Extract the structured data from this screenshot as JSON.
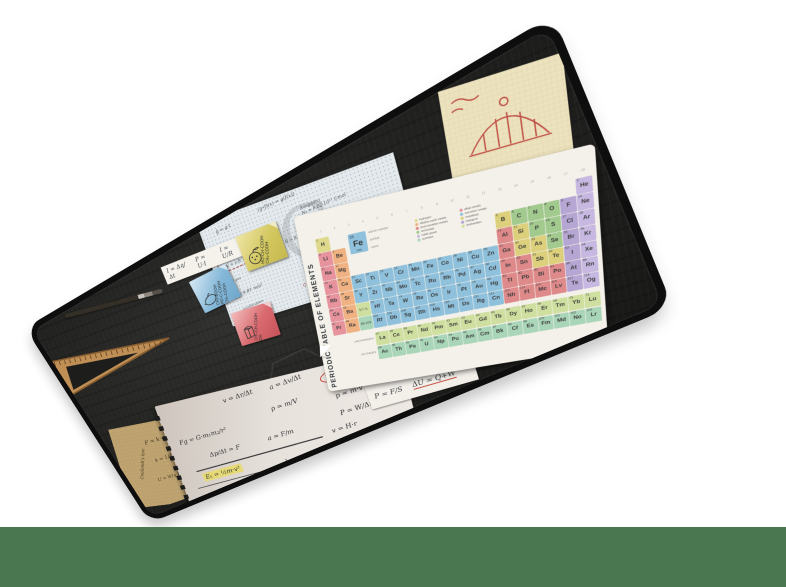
{
  "scene": {
    "background": "#ffffff",
    "bottom_bar_color": "#4a7750",
    "mat": {
      "surface_color": "#232322",
      "edge_color": "#0e0e0e",
      "brand": "natec"
    }
  },
  "periodic_table": {
    "title": "PERIODIC TABLE OF ELEMENTS",
    "group_numbers": [
      "1",
      "2",
      "3",
      "4",
      "5",
      "6",
      "7",
      "8",
      "9",
      "10",
      "11",
      "12",
      "13",
      "14",
      "15",
      "16",
      "17",
      "18"
    ],
    "sample": {
      "number": "26",
      "symbol": "Fe",
      "name": "Iron",
      "labels": [
        "atomic number",
        "symbol",
        "name"
      ]
    },
    "series_labels": {
      "lanthanides": "LANTHANIDES",
      "actinides": "ACTINIDES"
    },
    "legend": [
      {
        "label": "hydrogen",
        "key": "hy"
      },
      {
        "label": "alkali metals",
        "key": "alk"
      },
      {
        "label": "alkaline earth metals",
        "key": "ae"
      },
      {
        "label": "transition metals",
        "key": "tm"
      },
      {
        "label": "post-transition metals",
        "key": "ptm"
      },
      {
        "label": "metalloids",
        "key": "met"
      },
      {
        "label": "nonmetals",
        "key": "nm"
      },
      {
        "label": "halogens",
        "key": "hal"
      },
      {
        "label": "noble gases",
        "key": "ng"
      },
      {
        "label": "lanthanides",
        "key": "lan"
      },
      {
        "label": "actinides",
        "key": "act"
      }
    ],
    "colors": {
      "hy": "#ded98c",
      "alk": "#e6939e",
      "ae": "#f0b282",
      "tm": "#8fc1dc",
      "ptm": "#df8a8a",
      "met": "#dcd07c",
      "nm": "#a2ca8e",
      "hal": "#b5a6d4",
      "ng": "#c6b8e0",
      "lan": "#cfdf9f",
      "act": "#a9d5b8"
    },
    "grid": [
      [
        "1|H|hy",
        0,
        0,
        0,
        0,
        0,
        0,
        0,
        0,
        0,
        0,
        0,
        0,
        0,
        0,
        0,
        0,
        "2|He|ng"
      ],
      [
        "3|Li|alk",
        "4|Be|ae",
        0,
        0,
        0,
        0,
        0,
        0,
        0,
        0,
        0,
        0,
        "5|B|met",
        "6|C|nm",
        "7|N|nm",
        "8|O|nm",
        "9|F|hal",
        "10|Ne|ng"
      ],
      [
        "11|Na|alk",
        "12|Mg|ae",
        0,
        0,
        0,
        0,
        0,
        0,
        0,
        0,
        0,
        0,
        "13|Al|ptm",
        "14|Si|met",
        "15|P|nm",
        "16|S|nm",
        "17|Cl|hal",
        "18|Ar|ng"
      ],
      [
        "19|K|alk",
        "20|Ca|ae",
        "21|Sc|tm",
        "22|Ti|tm",
        "23|V|tm",
        "24|Cr|tm",
        "25|Mn|tm",
        "26|Fe|tm",
        "27|Co|tm",
        "28|Ni|tm",
        "29|Cu|tm",
        "30|Zn|tm",
        "31|Ga|ptm",
        "32|Ge|met",
        "33|As|met",
        "34|Se|nm",
        "35|Br|hal",
        "36|Kr|ng"
      ],
      [
        "37|Rb|alk",
        "38|Sr|ae",
        "39|Y|tm",
        "40|Zr|tm",
        "41|Nb|tm",
        "42|Mo|tm",
        "43|Tc|tm",
        "44|Ru|tm",
        "45|Rh|tm",
        "46|Pd|tm",
        "47|Ag|tm",
        "48|Cd|tm",
        "49|In|ptm",
        "50|Sn|ptm",
        "51|Sb|met",
        "52|Te|met",
        "53|I|hal",
        "54|Xe|ng"
      ],
      [
        "55|Cs|alk",
        "56|Ba|ae",
        "57-71||lan",
        "72|Hf|tm",
        "73|Ta|tm",
        "74|W|tm",
        "75|Re|tm",
        "76|Os|tm",
        "77|Ir|tm",
        "78|Pt|tm",
        "79|Au|tm",
        "80|Hg|tm",
        "81|Tl|ptm",
        "82|Pb|ptm",
        "83|Bi|ptm",
        "84|Po|ptm",
        "85|At|hal",
        "86|Rn|ng"
      ],
      [
        "87|Fr|alk",
        "88|Ra|ae",
        "89-103||act",
        "104|Rf|tm",
        "105|Db|tm",
        "106|Sg|tm",
        "107|Bh|tm",
        "108|Hs|tm",
        "109|Mt|tm",
        "110|Ds|tm",
        "111|Rg|tm",
        "112|Cn|tm",
        "113|Nh|ptm",
        "114|Fl|ptm",
        "115|Mc|ptm",
        "116|Lv|ptm",
        "117|Ts|hal",
        "118|Og|ng"
      ]
    ],
    "lanthanide_row": [
      "57|La|lan",
      "58|Ce|lan",
      "59|Pr|lan",
      "60|Nd|lan",
      "61|Pm|lan",
      "62|Sm|lan",
      "63|Eu|lan",
      "64|Gd|lan",
      "65|Tb|lan",
      "66|Dy|lan",
      "67|Ho|lan",
      "68|Er|lan",
      "69|Tm|lan",
      "70|Yb|lan",
      "71|Lu|lan"
    ],
    "actinide_row": [
      "89|Ac|act",
      "90|Th|act",
      "91|Pa|act",
      "92|U|act",
      "93|Np|act",
      "94|Pu|act",
      "95|Am|act",
      "96|Cm|act",
      "97|Bk|act",
      "98|Cf|act",
      "99|Es|act",
      "100|Fm|act",
      "101|Md|act",
      "102|No|act",
      "103|Lr|act"
    ]
  },
  "graph_paper": {
    "watermark": "G",
    "boxed": {
      "formula": "p·V = n·R·T",
      "caption": "ideal gas"
    },
    "notes": [
      {
        "t": "(g∘f)(x) = g(f(x))",
        "x": 32,
        "y": 3,
        "r": -4,
        "fs": 10
      },
      {
        "t": "ĝ = g·t",
        "x": 8,
        "y": 9,
        "r": -6,
        "fs": 10
      },
      {
        "t": "Planck\nh = 6.63·10⁻³⁴ J·s",
        "x": 8,
        "y": 22,
        "r": -5,
        "fs": 9
      },
      {
        "t": "Avogadro\nNₐ = 6.02·10²³ 1/mol",
        "x": 52,
        "y": 14,
        "r": -4,
        "fs": 9
      },
      {
        "t": "R = 8.31 J/mol·K",
        "x": 40,
        "y": 38,
        "r": -4,
        "fs": 9
      },
      {
        "t": "k = 1.38·10⁻²³ J/K",
        "x": 58,
        "y": 48,
        "r": -5,
        "fs": 9
      },
      {
        "t": "c = 3·10⁸ m/s",
        "x": 57,
        "y": 64,
        "r": -4,
        "fs": 9
      },
      {
        "t": "G = 6.67·10⁻¹¹ N·m²/kg²",
        "x": 42,
        "y": 80,
        "r": -4,
        "fs": 9,
        "c": "#b2423a"
      },
      {
        "t": "g = 9.81 m/s²",
        "x": 6,
        "y": 70,
        "r": -6,
        "fs": 10
      },
      {
        "t": "acceleration",
        "x": 8,
        "y": 84,
        "r": -6,
        "fs": 8
      }
    ]
  },
  "electric_strip": {
    "formulas": [
      "I = Δq/Δt",
      "P = U·I",
      "I = U/R"
    ]
  },
  "pressure_strip": {
    "formulas": [
      "P = F/S",
      "ΔU = Q+W"
    ]
  },
  "kraft_note": {
    "title": "Coulomb's law",
    "formulas": [
      "F = k·q₁q₂ / r²",
      "k = 1/4πε₀",
      "U = W/q    E = F/q"
    ]
  },
  "sticky_notes": [
    {
      "name": "lactic-acid",
      "formula": "CH₃-CH-COOH\nOH"
    },
    {
      "name": "citric-acid",
      "formula": "CH₂-COOH\nHO-C-COOH\nCH₂-COOH"
    },
    {
      "name": "malic-acid",
      "formula": "HO-CH-COOH\nCH₂-COOH"
    }
  ],
  "notebook": {
    "brand": "natec",
    "formulas": [
      {
        "t": "v = Δr/Δt",
        "x": 29,
        "y": 4,
        "r": -5
      },
      {
        "t": "a = Δv/Δt",
        "x": 49,
        "y": 2,
        "r": -7
      },
      {
        "t": "E=mc²",
        "x": 69,
        "y": 3,
        "r": -8,
        "s": "circle"
      },
      {
        "t": "ρ = m/V",
        "x": 47,
        "y": 17,
        "r": -5
      },
      {
        "t": "p = m·v",
        "x": 73,
        "y": 18,
        "r": -6
      },
      {
        "t": "Fg = G·m₁m₂/r²",
        "x": 5,
        "y": 26,
        "r": -4
      },
      {
        "t": "P = W/Δt",
        "x": 73,
        "y": 30,
        "r": -6
      },
      {
        "t": "Δp/Δt = F",
        "x": 16,
        "y": 40,
        "r": -4
      },
      {
        "t": "a = F/m",
        "x": 42,
        "y": 37,
        "r": -5
      },
      {
        "t": "v = H·r",
        "x": 68,
        "y": 41,
        "r": -6
      },
      {
        "t": "Eₖ = ½m·v²",
        "x": 10,
        "y": 55,
        "r": -4,
        "s": "hl"
      },
      {
        "t": "λ = v·T",
        "x": 46,
        "y": 56,
        "r": -5
      },
      {
        "t": "c = Q/m·ΔT",
        "x": 68,
        "y": 52,
        "r": -7
      },
      {
        "t": "f = 1/T",
        "x": 30,
        "y": 68,
        "r": -5
      },
      {
        "t": "v = p/m",
        "x": 54,
        "y": 66,
        "r": -6
      },
      {
        "t": "Cp–Cv = R",
        "x": 72,
        "y": 63,
        "r": -7
      }
    ]
  }
}
